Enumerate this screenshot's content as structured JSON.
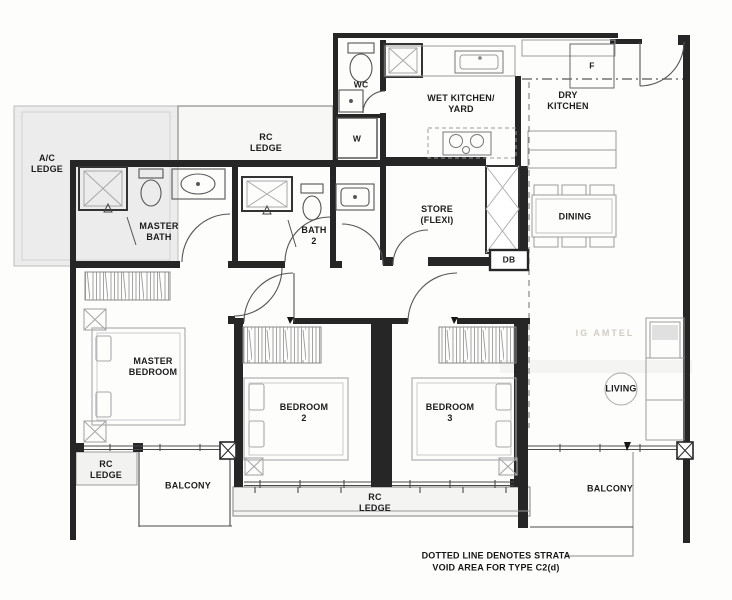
{
  "plan_type": "residential-floor-plan",
  "colors": {
    "wall": "#262626",
    "thin_line": "#4a4a4a",
    "fixture_line": "#9a9a9a",
    "ledge_fill": "#ececec",
    "text": "#1c1c1c",
    "watermark": "#b3ab9e"
  },
  "rooms": {
    "ac_ledge": "A/C\nLEDGE",
    "rc_ledge_top": "RC\nLEDGE",
    "wet_kitchen": "WET KITCHEN/\nYARD",
    "dry_kitchen": "DRY\nKITCHEN",
    "master_bath": "MASTER\nBATH",
    "bath_2": "BATH\n2",
    "store": "STORE\n(FLEXI)",
    "dining": "DINING",
    "master_bedroom": "MASTER\nBEDROOM",
    "bedroom_2": "BEDROOM\n2",
    "bedroom_3": "BEDROOM\n3",
    "living": "LIVING",
    "rc_ledge_left": "RC\nLEDGE",
    "balcony_left": "BALCONY",
    "rc_ledge_center": "RC\nLEDGE",
    "balcony_right": "BALCONY"
  },
  "fixtures": {
    "wc": "WC",
    "washer": "W",
    "fridge": "F",
    "db": "DB"
  },
  "annotations": {
    "strata_note": "DOTTED LINE DENOTES STRATA\nVOID AREA FOR TYPE C2(d)",
    "watermark": "IG AMTEL"
  }
}
